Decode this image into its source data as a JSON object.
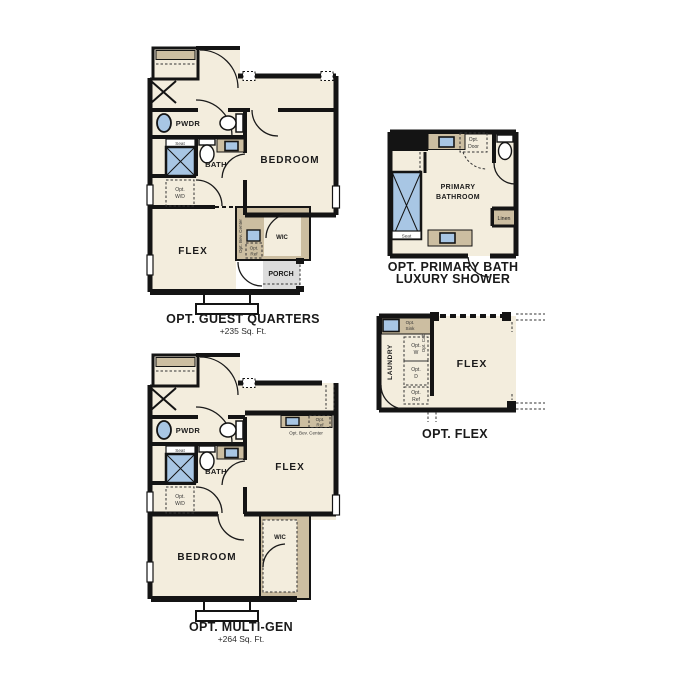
{
  "figure": {
    "type": "floor-plan-options-sheet",
    "background": "#ffffff"
  },
  "colors": {
    "wall": "#141414",
    "floor": "#f3eddd",
    "counter": "#ccbea1",
    "fixture_blue": "#a8c6e4",
    "porch_gray": "#dcdcdc",
    "text": "#1a1a1a"
  },
  "plans": {
    "guest": {
      "title": "OPT. GUEST QUARTERS",
      "subtitle": "+235 Sq. Ft.",
      "labels": {
        "pwdr": "PWDR",
        "seat": "Seat",
        "bath": "BATH",
        "opt_wd_1": "Opt.",
        "opt_wd_2": "W/D",
        "bedroom": "BEDROOM",
        "flex": "FLEX",
        "bev_center": "Opt. Bev. Center",
        "opt_ref_1": "Opt.",
        "opt_ref_2": "Ref",
        "wic": "WIC",
        "porch": "PORCH"
      }
    },
    "primary": {
      "title_1": "OPT. PRIMARY BATH",
      "title_2": "LUXURY SHOWER",
      "labels": {
        "room_1": "PRIMARY",
        "room_2": "BATHROOM",
        "opt_door_1": "Opt.",
        "opt_door_2": "Door",
        "linen": "Linen",
        "seat": "Seat"
      }
    },
    "flex": {
      "title": "OPT. FLEX",
      "labels": {
        "laundry": "LAUNDRY",
        "opt_sink_1": "Opt.",
        "opt_sink_2": "Sink",
        "opt_cab": "Opt. Cab",
        "opt_w_1": "Opt.",
        "opt_w_2": "W",
        "opt_d_1": "Opt.",
        "opt_d_2": "D",
        "opt_ref_1": "Opt.",
        "opt_ref_2": "Ref",
        "flex": "FLEX"
      }
    },
    "multigen": {
      "title": "OPT. MULTI-GEN",
      "subtitle": "+264 Sq. Ft.",
      "labels": {
        "pwdr": "PWDR",
        "seat": "Seat",
        "bath": "BATH",
        "opt_wd_1": "Opt.",
        "opt_wd_2": "W/D",
        "bedroom": "BEDROOM",
        "flex": "FLEX",
        "bev_center": "Opt. Bev. Center",
        "opt_ref_1": "Opt.",
        "opt_ref_2": "Ref",
        "wic": "WIC"
      }
    }
  }
}
